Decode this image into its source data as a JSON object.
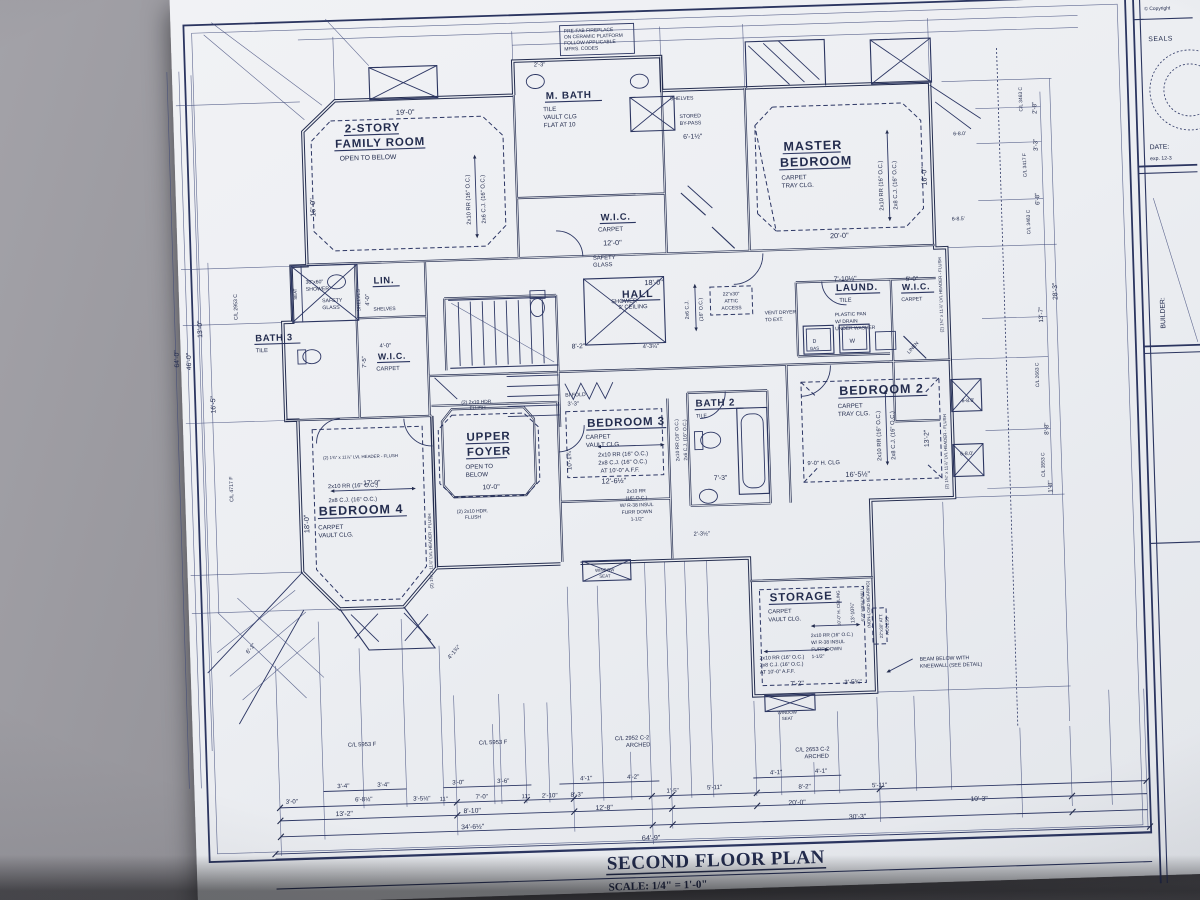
{
  "title": {
    "main": "SECOND FLOOR PLAN",
    "scale": "SCALE: 1/4\" = 1'-0\""
  },
  "titleblock": {
    "copyright": "© Copyright",
    "seals": "SEALS",
    "date": "DATE:",
    "exp": "exp. 12-3",
    "builder": "BUILDER:"
  },
  "rooms": {
    "family": {
      "name": "2-STORY",
      "name2": "FAMILY ROOM",
      "note": "OPEN TO BELOW",
      "dim_top": "19'-0\"",
      "dim_left": "16'-0\"",
      "joists": "2x10 RR (16\" O.C.)",
      "joists2": "2x6 C.J. (16\" O.C.)"
    },
    "mbath": {
      "name": "M. BATH",
      "finish": "TILE",
      "clg": "VAULT CLG",
      "clg2": "FLAT AT 10",
      "safety": "SAFETY",
      "safety2": "GLASS",
      "shower": "SHOWER",
      "dim_top": "2'-3\""
    },
    "mwic": {
      "name": "W.I.C.",
      "finish": "CARPET",
      "dim": "12'-0\""
    },
    "closet": {
      "shelves": "SHELVES",
      "bypass": "STORED",
      "bypass2": "BY-PASS",
      "dim": "6'-1½\""
    },
    "master": {
      "name": "MASTER",
      "name2": "BEDROOM",
      "finish": "CARPET",
      "clg": "TRAY CLG.",
      "dim_bottom": "20'-0\"",
      "dim_right": "16'-0\"",
      "joists": "2x10 RR (16\" O.C.)",
      "joists2": "2x8 C.J. (16\" O.C.)"
    },
    "bath3": {
      "name": "BATH 3",
      "finish": "TILE",
      "shower": "30\"x60\"",
      "shower2": "SHOWER",
      "seat": "SEAT",
      "safety": "SAFETY",
      "safety2": "GLASS"
    },
    "lin": {
      "name": "LIN.",
      "shelves": "SHELVES",
      "shelves2": "SHELVES",
      "dim": "4'-0\""
    },
    "wic2": {
      "name": "W.I.C.",
      "finish": "CARPET",
      "dim": "4'-0\"",
      "dim2": "7'-5\""
    },
    "hall": {
      "name": "HALL",
      "clg": "9' CEILING",
      "dim": "18'-0\"",
      "joists": "2x6 C.J.",
      "joists2": "(16\" O.C.)",
      "attic": "22\"x30\"",
      "attic2": "ATTIC",
      "attic3": "ACCESS",
      "vent": "VENT DRYER",
      "vent2": "TO EXT.",
      "stair_dim": "8'-2\"",
      "dim2": "4'-3¼\"",
      "bifold": "BI-FOLD",
      "bifold_dim": "3'-3\""
    },
    "laund": {
      "name": "LAUND.",
      "finish": "TILE",
      "dim": "7'-10½\"",
      "pan": "PLASTIC PAN",
      "pan2": "W/ DRAIN",
      "pan3": "UNDER WASHER",
      "d": "D",
      "gas": "GAS",
      "w": "W"
    },
    "wic3": {
      "name": "W.I.C.",
      "finish": "CARPET",
      "dim": "5'-0\"",
      "linen": "LINEN"
    },
    "bed2": {
      "name": "BEDROOM 2",
      "finish": "CARPET",
      "clg": "TRAY CLG.",
      "hclg": "9'-0\" H. CLG",
      "dim": "16'-5½\"",
      "dim_right": "13'-2\"",
      "joists": "2x10 RR (16\" O.C.)",
      "joists2": "2x8 C.J. (16\" O.C.)"
    },
    "bed3": {
      "name": "BEDROOM 3",
      "finish": "CARPET",
      "clg": "VAULT CLG",
      "joists": "2x10 RR (16\" O.C.)",
      "joists2": "2x8 C.J. (16\" O.C.)",
      "joists3": "AT 10'-0\" A.F.F.",
      "dim": "12'-6½\"",
      "dim_left": "10'-1¾\"",
      "furr": "2x10 RR",
      "furr2": "(16\" O.C.)",
      "furr3": "W/ R-38 INSUL",
      "furr4": "FURR DOWN",
      "furr5": "1-1/2\"",
      "dim2": "2'-3½\"",
      "seat": "WINDOW",
      "seat2": "SEAT"
    },
    "bath2": {
      "name": "BATH 2",
      "finish": "TILE",
      "dim": "7'-3\"",
      "joists": "2x10 RR (16\" O.C.)",
      "joists2": "2x6 C.J. (16\" O.C.)"
    },
    "foyer": {
      "name": "UPPER",
      "name2": "FOYER",
      "note": "OPEN TO",
      "note2": "BELOW",
      "dim": "10'-0\""
    },
    "bed4": {
      "name": "BEDROOM 4",
      "finish": "CARPET",
      "clg": "VAULT CLG.",
      "dim_top": "17'-0\"",
      "dim_left": "18'-0\"",
      "joists": "2x10 RR (16\" O.C.)",
      "joists2": "2x8 C.J. (16\" O.C.)"
    },
    "storage": {
      "name": "STORAGE",
      "finish": "CARPET",
      "clg": "VAULT CLG.",
      "joists": "2x10 RR (16\" O.C.)",
      "joists2": "2x8 C.J. (16\" O.C.)",
      "joists3": "AT 10'-0\" A.F.F.",
      "furr": "2x10 RR (16\" O.C.)",
      "furr2": "W/ R-38 INSUL",
      "furr3": "FURR DOWN",
      "furr4": "1-1/2\"",
      "dim1": "7'-2\"",
      "dim2": "3'-5¾\"",
      "hclg": "10'-0\" H. CEILING",
      "dimv": "13'-10¾\"",
      "wall": "6'-9\" HIGH WALL",
      "wall2": "(NON-LOAD BEARING)",
      "attic": "22\"x30\" ATT.",
      "attic2": "ACCESS",
      "seat": "WINDOW",
      "seat2": "SEAT"
    }
  },
  "notes": {
    "fireplace": "PRE-FAB FIREPLACE",
    "fireplace2": "ON CERAMIC PLATFORM",
    "fireplace3": "FOLLOW APPLICABLE",
    "fireplace4": "MFRS. CODES",
    "beam": "BEAM BELOW WITH",
    "beam2": "KNEEWALL (SEE DETAIL)",
    "hdr": "(2) 2x10 HDR.",
    "hdr2": "FLUSH",
    "lvl": "(2) 1¾\" x 11⅞\" LVL HEADER - FLUSH"
  },
  "dims": {
    "bottom": {
      "cl1": "C/L 5953 F",
      "cl2": "C/L 5953 F",
      "cl3": "C/L 2952 C-2",
      "cl3b": "ARCHED",
      "cl4": "C/L 2653 C-2",
      "cl4b": "ARCHED",
      "row1": [
        "3'-4\"",
        "3'-4\"",
        "3'-0\"",
        "3'-6\"",
        "4'-1\"",
        "4'-2\"",
        "4'-1\"",
        "4'-1\""
      ],
      "row2": [
        "3'-0\"",
        "6'-8½\"",
        "3'-5½\"",
        "11\"",
        "7'-0\"",
        "11\"",
        "2'-10\"",
        "8'-3\"",
        "1'-5\"",
        "5'-11\"",
        "8'-2\"",
        "5'-11\""
      ],
      "row3": [
        "13'-2\"",
        "8'-10\"",
        "12'-8\"",
        "20'-0\"",
        "10'-3\""
      ],
      "row4": [
        "34'-6½\"",
        "30'-3\""
      ],
      "total": "64'-9\""
    },
    "left": [
      "64'-0\"",
      "46'-0\"",
      "13'-0\"",
      "16'-5\"",
      "C/L 2953 C",
      "C/L 4717 F"
    ],
    "right": [
      "2'-8\"",
      "3'-3\"",
      "6'-8\"",
      "13'-7\"",
      "8'-8\"",
      "1'-8\"",
      "28'-3\"",
      "C/L 3463 C",
      "C/L 3417 F",
      "C/L 3463 C",
      "C/L 2663 C",
      "C/L 3553 C"
    ],
    "callouts": [
      "6-8.0'",
      "6-8.5'",
      "6-8.0'",
      "6-8.0'"
    ],
    "angled": [
      "6'-1\"",
      "4'-1¾\""
    ]
  }
}
